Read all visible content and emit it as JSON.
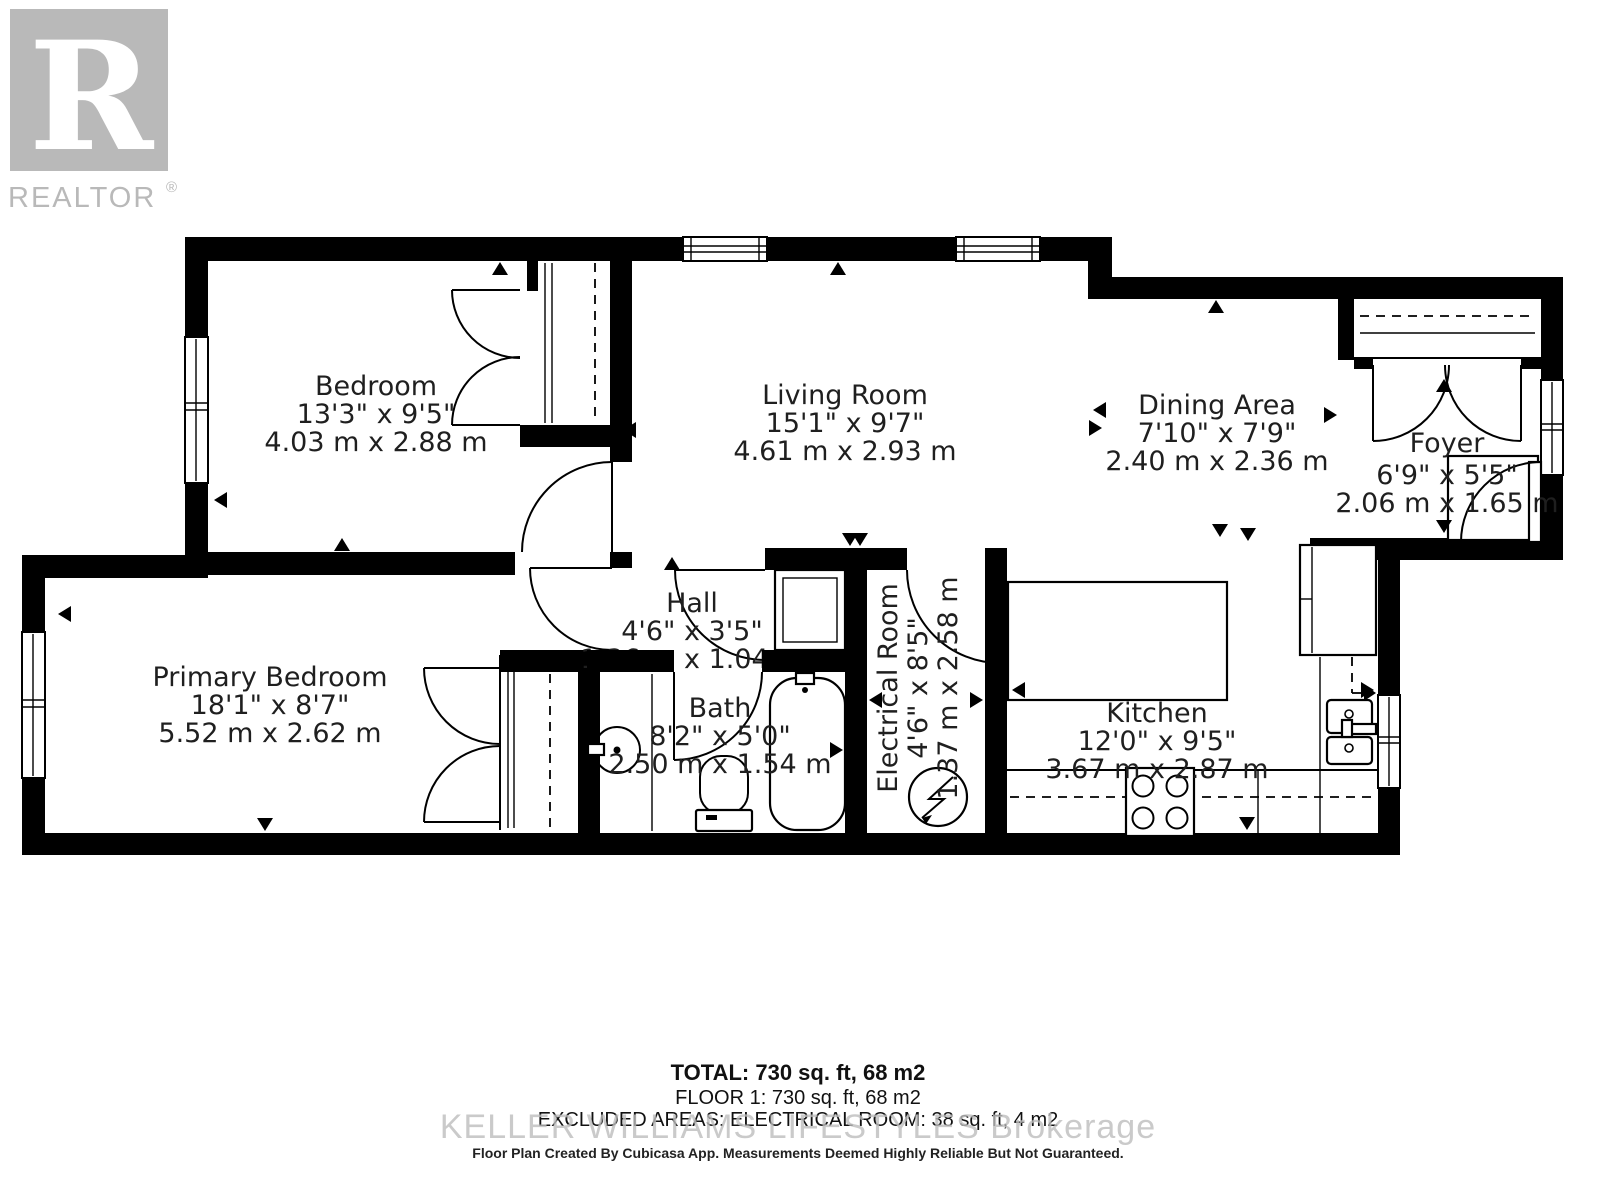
{
  "logo": {
    "mark": "R",
    "brand": "REALTOR",
    "registered": "®",
    "color": "#b9b9b9"
  },
  "rooms": {
    "bedroom": {
      "name": "Bedroom",
      "imperial": "13'3\" x 9'5\"",
      "metric": "4.03 m x 2.88 m"
    },
    "living": {
      "name": "Living Room",
      "imperial": "15'1\" x 9'7\"",
      "metric": "4.61 m x 2.93 m"
    },
    "dining": {
      "name": "Dining Area",
      "imperial": "7'10\" x 7'9\"",
      "metric": "2.40 m x 2.36 m"
    },
    "foyer": {
      "name": "Foyer",
      "imperial": "6'9\" x 5'5\"",
      "metric": "2.06 m x 1.65 m"
    },
    "primary": {
      "name": "Primary Bedroom",
      "imperial": "18'1\" x 8'7\"",
      "metric": "5.52 m x 2.62 m"
    },
    "hall": {
      "name": "Hall",
      "imperial": "4'6\" x 3'5\"",
      "metric": "1.36 m x 1.04 m"
    },
    "bath": {
      "name": "Bath",
      "imperial": "8'2\" x 5'0\"",
      "metric": "2.50 m x 1.54 m"
    },
    "electrical": {
      "name": "Electrical Room",
      "imperial": "4'6\" x 8'5\"",
      "metric": "1.37 m x 2.58 m"
    },
    "kitchen": {
      "name": "Kitchen",
      "imperial": "12'0\" x 9'5\"",
      "metric": "3.67 m x 2.87 m"
    }
  },
  "footer": {
    "total": "TOTAL: 730 sq. ft, 68 m2",
    "floor": "FLOOR 1: 730 sq. ft, 68 m2",
    "excluded": "EXCLUDED AREAS: ELECTRICAL ROOM: 38 sq. ft, 4 m2",
    "watermark": "KELLER WILLIAMS LIFESTYLES Brokerage",
    "disclaimer": "Floor Plan Created By Cubicasa App. Measurements Deemed Highly Reliable But Not Guaranteed."
  },
  "colors": {
    "wall": "#000000",
    "background": "#ffffff",
    "label": "#1f1f1f",
    "logo_gray": "#b9b9b9",
    "watermark_gray": "#bdbdbd"
  }
}
